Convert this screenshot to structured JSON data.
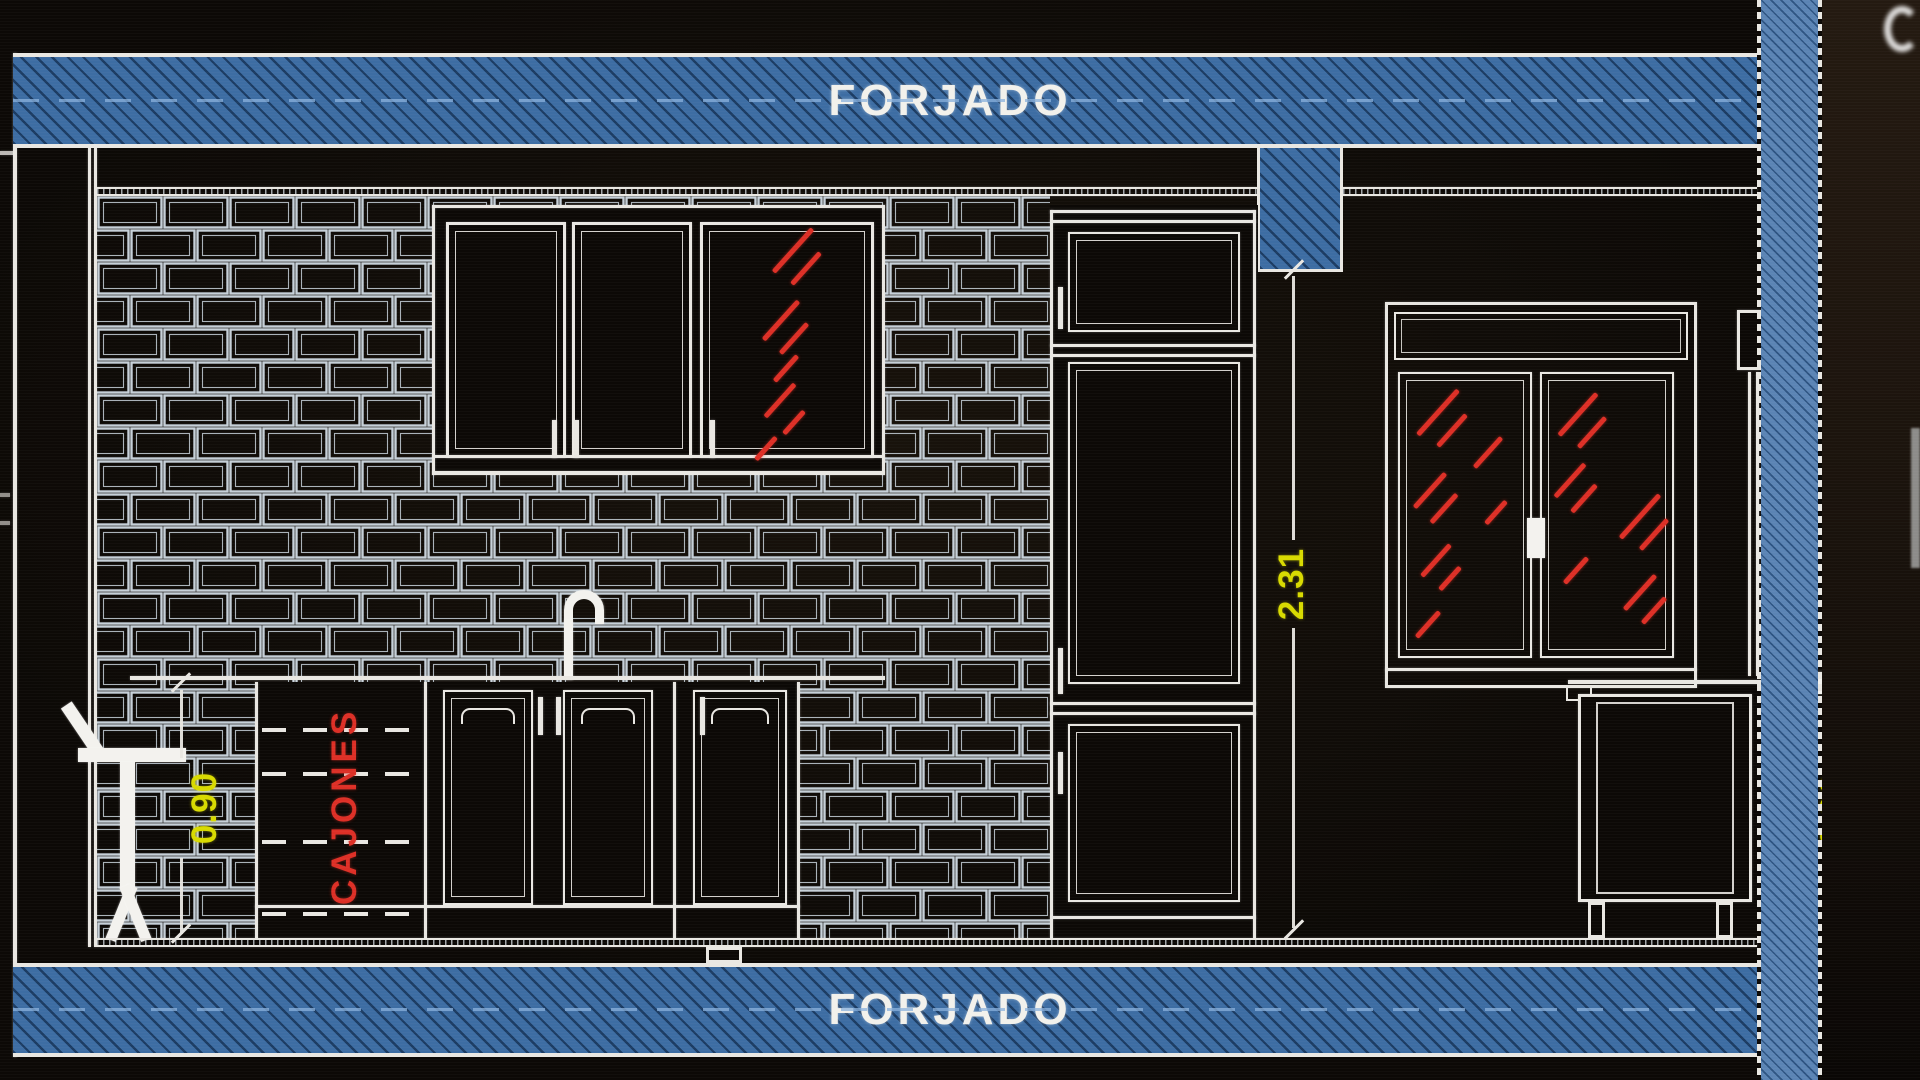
{
  "drawing": {
    "type": "kitchen-elevation-cad",
    "labels": {
      "slab_top": "FORJADO",
      "slab_bottom": "FORJADO",
      "drawers": "CAJONES"
    },
    "dimensions": {
      "wall_height": "2.31",
      "left_counter_height": "0.90",
      "right_counter_height": "0.90"
    }
  },
  "colors": {
    "paper": "#0c0906",
    "line": "#e9e7e2",
    "brick-line": "#c6d0d8",
    "blue-band": "#3d6da3",
    "blue-hatch": "#1c3c63",
    "blue-light": "#5b84b4",
    "blue-light-hatch": "#2e5482",
    "blue-dash": "#8ab1dc",
    "red": "#dd2f26",
    "yellow": "#d8da00",
    "white-fill": "#f3f2ee"
  }
}
